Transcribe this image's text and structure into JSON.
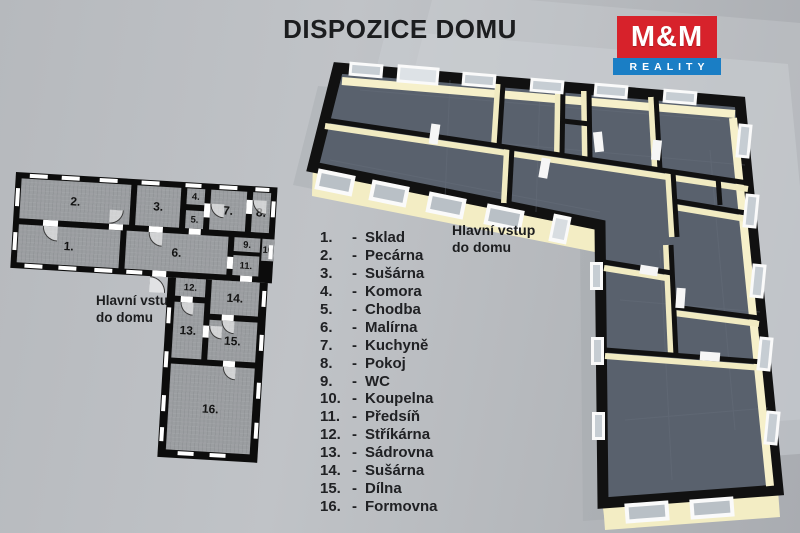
{
  "title": "DISPOZICE DOMU",
  "logo": {
    "top": "M&M",
    "bottom": "REALITY"
  },
  "entrance_2d": {
    "line1": "Hlavní vstup",
    "line2": "do domu"
  },
  "entrance_3d": {
    "line1": "Hlavní vstup",
    "line2": "do domu"
  },
  "legend": {
    "dash": "-",
    "items": [
      {
        "number": "1.",
        "name": "Sklad"
      },
      {
        "number": "2.",
        "name": "Pecárna"
      },
      {
        "number": "3.",
        "name": "Sušárna"
      },
      {
        "number": "4.",
        "name": "Komora"
      },
      {
        "number": "5.",
        "name": "Chodba"
      },
      {
        "number": "6.",
        "name": "Malírna"
      },
      {
        "number": "7.",
        "name": "Kuchyně"
      },
      {
        "number": "8.",
        "name": "Pokoj"
      },
      {
        "number": "9.",
        "name": "WC"
      },
      {
        "number": "10.",
        "name": "Koupelna"
      },
      {
        "number": "11.",
        "name": "Předsíň"
      },
      {
        "number": "12.",
        "name": "Stříkárna"
      },
      {
        "number": "13.",
        "name": "Sádrovna"
      },
      {
        "number": "14.",
        "name": "Sušárna"
      },
      {
        "number": "15.",
        "name": "Dílna"
      },
      {
        "number": "16.",
        "name": "Formovna"
      }
    ]
  },
  "plan2d": {
    "room_numbers": [
      "1.",
      "2.",
      "3.",
      "4.",
      "5.",
      "6.",
      "7.",
      "8.",
      "9.",
      "10",
      "11.",
      "12.",
      "13.",
      "14.",
      "15.",
      "16."
    ]
  },
  "colors": {
    "logo_red": "#d7222b",
    "logo_blue": "#1a7ec5",
    "wall_black": "#0c0c0c",
    "room_gray_2d": "#9b9ea1",
    "floor_3d": "#59616d",
    "wall_cream_3d": "#f1ebc2",
    "background": "#b4b7bb"
  }
}
